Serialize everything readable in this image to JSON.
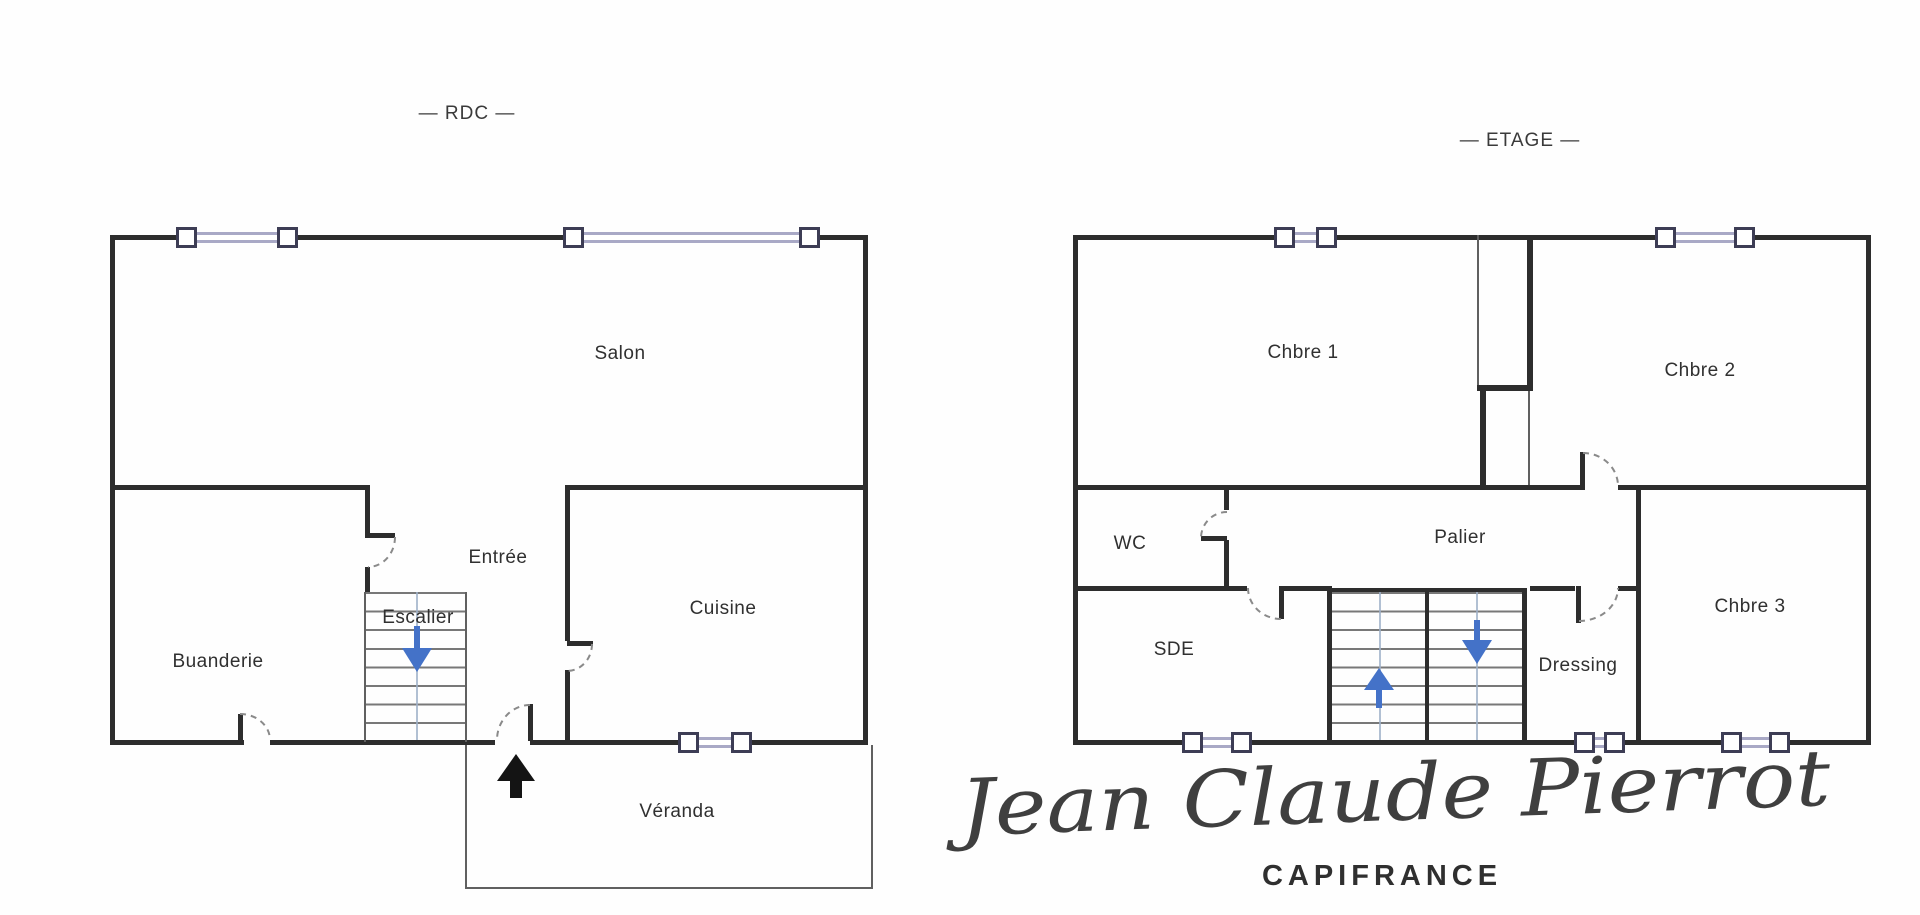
{
  "floorplans": {
    "rdc": {
      "title": "— RDC —",
      "rooms": {
        "salon": "Salon",
        "entree": "Entrée",
        "escalier": "Escalier",
        "buanderie": "Buanderie",
        "cuisine": "Cuisine",
        "veranda": "Véranda"
      }
    },
    "etage": {
      "title": "— ETAGE —",
      "rooms": {
        "chbre1": "Chbre 1",
        "chbre2": "Chbre 2",
        "chbre3": "Chbre 3",
        "wc": "WC",
        "palier": "Palier",
        "sde": "SDE",
        "dressing": "Dressing"
      }
    }
  },
  "branding": {
    "signature": "Jean Claude Pierrot",
    "agency": "CAPIFRANCE"
  },
  "colors": {
    "wall": "#2d2d2d",
    "thin": "#606060",
    "tread": "#787878",
    "sill": "#a9a9c6",
    "pane_border": "#3d3d55",
    "blue": "#4472c8",
    "black": "#141414",
    "text": "#303030",
    "sig": "#3f3f3f"
  }
}
